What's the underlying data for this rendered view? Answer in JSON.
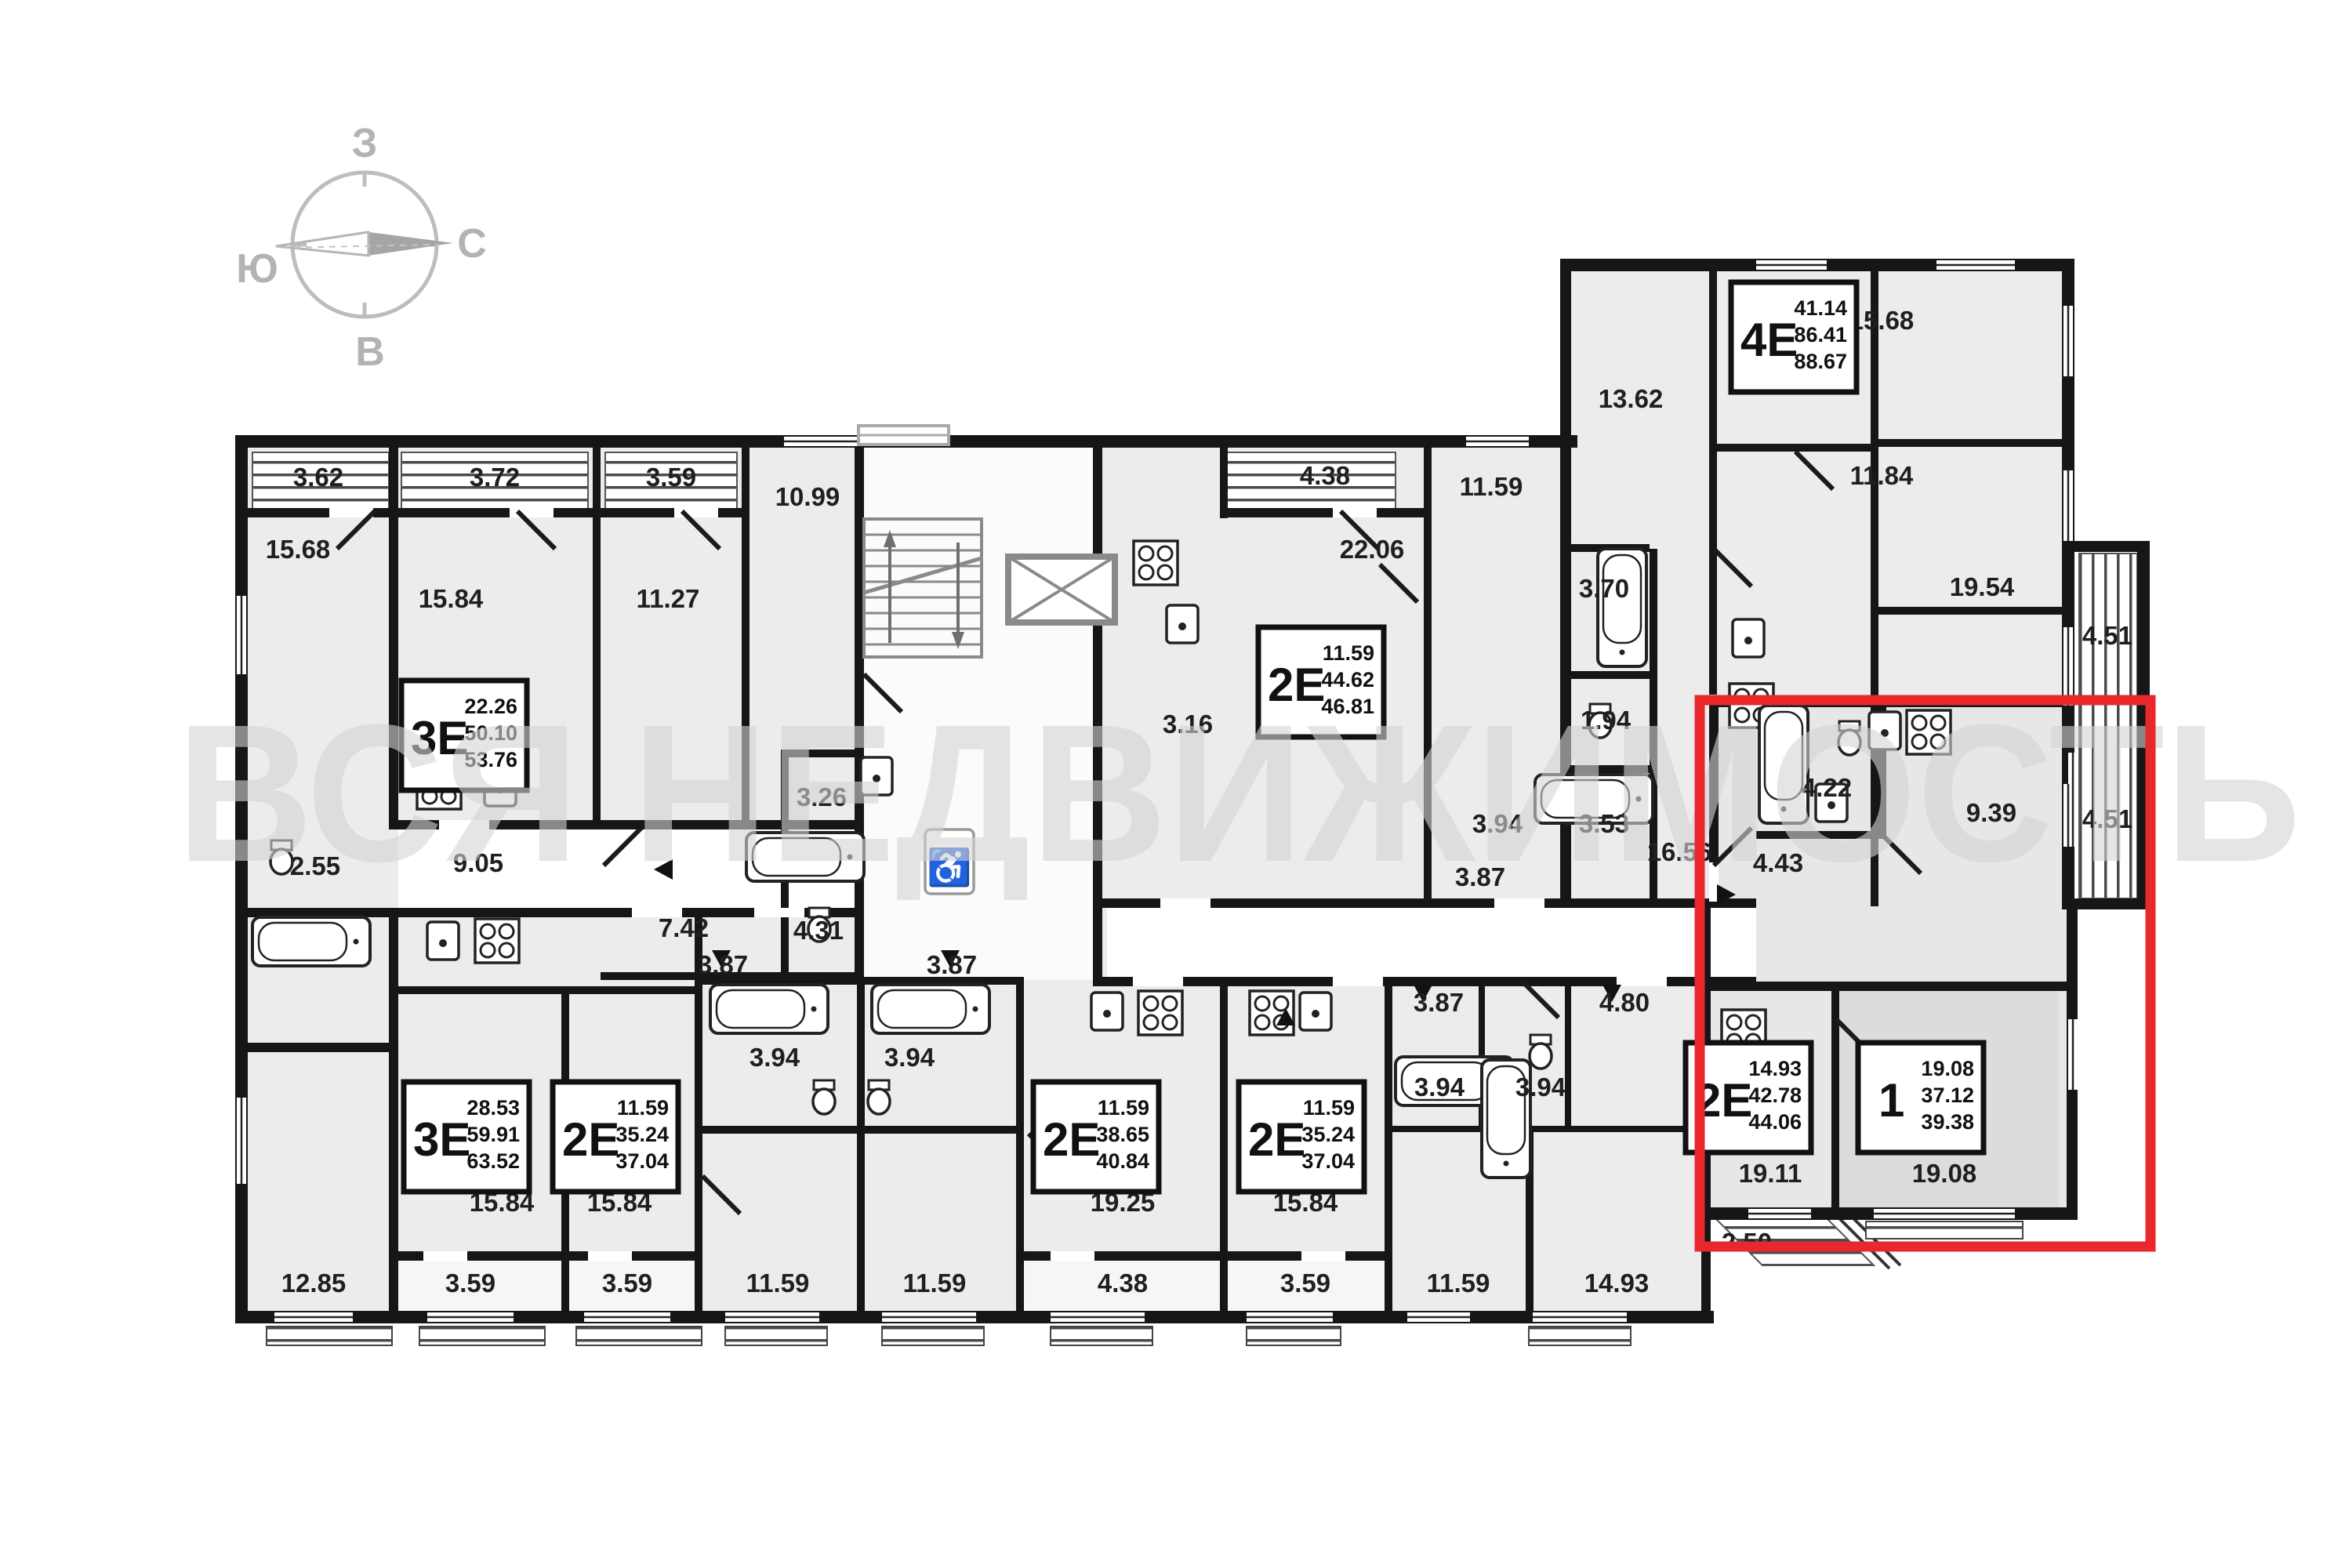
{
  "watermark": "ВСЯ НЕДВИЖИМОСТЬ",
  "compass": {
    "top": "З",
    "right": "С",
    "bottom": "В",
    "left": "Ю"
  },
  "colors": {
    "highlight": "#e8282c",
    "wall": "#161616",
    "room_fill": "#ececec",
    "room_fill_dark": "#dcdcdc"
  },
  "apartments": [
    {
      "type": "3E",
      "l1": "22.26",
      "l2": "50.10",
      "l3": "53.76"
    },
    {
      "type": "2E",
      "l1": "11.59",
      "l2": "44.62",
      "l3": "46.81"
    },
    {
      "type": "4E",
      "l1": "41.14",
      "l2": "86.41",
      "l3": "88.67"
    },
    {
      "type": "3E",
      "l1": "28.53",
      "l2": "59.91",
      "l3": "63.52"
    },
    {
      "type": "2E",
      "l1": "11.59",
      "l2": "35.24",
      "l3": "37.04"
    },
    {
      "type": "2E",
      "l1": "11.59",
      "l2": "38.65",
      "l3": "40.84"
    },
    {
      "type": "2E",
      "l1": "11.59",
      "l2": "35.24",
      "l3": "37.04"
    },
    {
      "type": "2E",
      "l1": "14.93",
      "l2": "42.78",
      "l3": "44.06"
    },
    {
      "type": "1",
      "l1": "19.08",
      "l2": "37.12",
      "l3": "39.38"
    }
  ],
  "area_labels": [
    "3.62",
    "3.72",
    "3.59",
    "10.99",
    "15.68",
    "15.84",
    "11.27",
    "3.26",
    "4.31",
    "7.42",
    "2.55",
    "9.05",
    "4.38",
    "22.06",
    "3.16",
    "11.59",
    "3.70",
    "1.94",
    "3.53",
    "3.94",
    "3.87",
    "16.56",
    "13.62",
    "15.68",
    "11.84",
    "19.54",
    "4.51",
    "9.39",
    "4.51",
    "4.22",
    "4.43",
    "3.87",
    "3.87",
    "3.94",
    "3.94",
    "3.87",
    "3.94",
    "3.94",
    "4.80",
    "15.84",
    "15.84",
    "19.25",
    "15.84",
    "19.11",
    "19.08",
    "12.85",
    "3.59",
    "3.59",
    "11.59",
    "11.59",
    "4.38",
    "3.59",
    "11.59",
    "14.93",
    "2.50"
  ]
}
